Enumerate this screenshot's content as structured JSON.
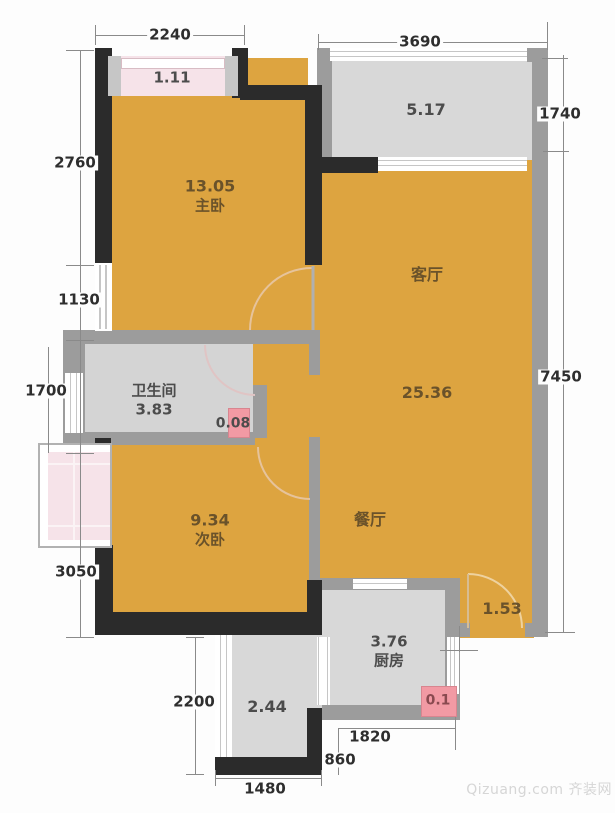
{
  "rooms": {
    "master_bedroom": {
      "area": "13.05",
      "name": "主卧"
    },
    "living_room": {
      "name": "客厅",
      "area": "25.36"
    },
    "dining_room": {
      "name": "餐厅"
    },
    "bathroom": {
      "name": "卫生间",
      "area": "3.83"
    },
    "second_bedroom": {
      "area": "9.34",
      "name": "次卧"
    },
    "kitchen": {
      "area": "3.76",
      "name": "厨房"
    },
    "balcony_top": {
      "area": "5.17"
    },
    "bay_window_top": {
      "area": "1.11"
    },
    "balcony_bottom": {
      "area": "2.44"
    },
    "entry": {
      "area": "1.53"
    },
    "duct_bathroom": {
      "area": "0.08"
    },
    "duct_kitchen": {
      "area": "0.1"
    }
  },
  "dimensions_mm": {
    "top_left": "2240",
    "top_right": "3690",
    "right_upper": "1740",
    "right_main": "7450",
    "left_1": "2760",
    "left_2": "1130",
    "left_3": "1700",
    "left_4": "3050",
    "left_5": "2200",
    "bottom_balcony": "1480",
    "bottom_kitchen": "1820",
    "bottom_entry": "860"
  },
  "watermark": "Qizuang.com 齐装网",
  "colors": {
    "room_fill_orange": "#dda440",
    "room_fill_gray": "#d8d8d8",
    "wall_dark": "#2b2b2b",
    "wall_gray": "#9c9c9c",
    "bay_pink": "#f6e3e9",
    "accent_pink": "#f29aa4"
  }
}
